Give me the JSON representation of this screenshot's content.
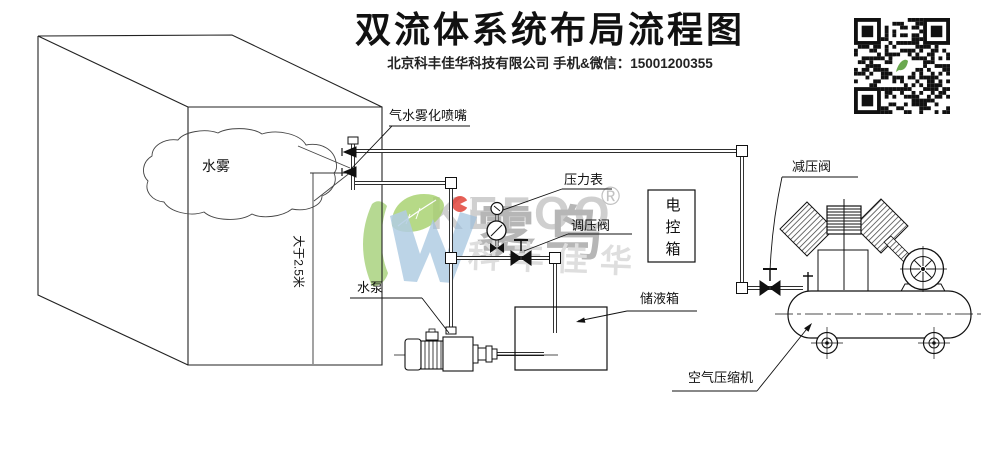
{
  "header": {
    "title": "双流体系统布局流程图",
    "subtitle": "北京科丰佳华科技有限公司 手机&微信：15001200355"
  },
  "labels": {
    "nozzle": "气水雾化喷嘴",
    "pressure_gauge": "压力表",
    "regulating_valve": "调压阀",
    "control_box": "电控箱",
    "reducing_valve": "减压阀",
    "water_pump": "水泵",
    "storage_tank": "储液箱",
    "air_compressor": "空气压缩机",
    "water_mist": "水雾",
    "height_note": "大于2.5米"
  },
  "watermark": {
    "brand": "KEFOO",
    "cn_name": "雾鸟",
    "registered": "®",
    "company_short": "科丰佳华"
  },
  "colors": {
    "line": "#1a1a1a",
    "watermark_gray": "#bdbdbd",
    "logo_green": "#8fc455",
    "logo_blue": "#9dbfdc",
    "logo_red": "#e0392e"
  }
}
